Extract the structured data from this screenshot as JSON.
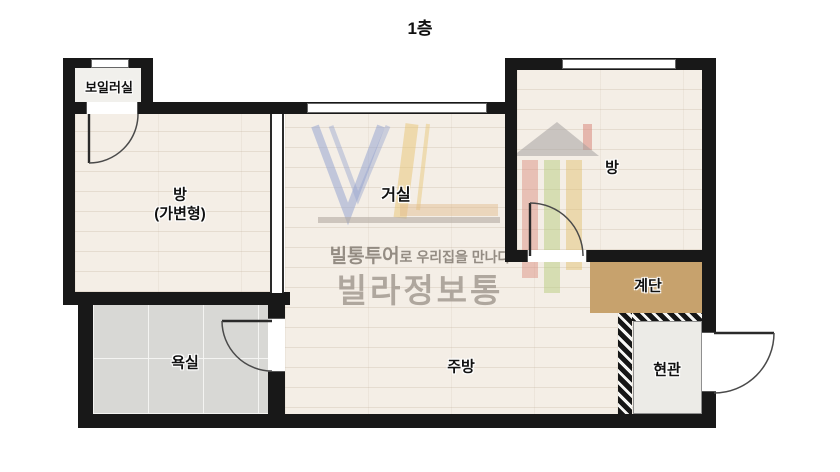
{
  "floor_title": "1층",
  "rooms": {
    "boiler": {
      "label": "보일러실"
    },
    "left_room": {
      "label": "방",
      "sublabel": "(가변형)"
    },
    "living": {
      "label": "거실"
    },
    "right_room": {
      "label": "방"
    },
    "stairs": {
      "label": "계단"
    },
    "bathroom": {
      "label": "욕실"
    },
    "kitchen": {
      "label": "주방"
    },
    "entrance": {
      "label": "현관"
    }
  },
  "watermark": {
    "tagline_bold": "빌통투어",
    "tagline_tail": "로 우리집을 만나다",
    "brand": "빌라정보통"
  },
  "colors": {
    "wall": "#181818",
    "wood_floor": "#f4eee6",
    "bathroom_tile": "#d8d8d5",
    "stairs": "#c7a26d",
    "entrance_floor": "#ecebe7",
    "boiler_floor": "#f1f0ec",
    "logo_blue": "#97a5cf",
    "logo_yellow": "#e7c472",
    "logo_red": "#db9184",
    "logo_green": "#b8cc7d",
    "watermark_gray": "#a49b92"
  }
}
